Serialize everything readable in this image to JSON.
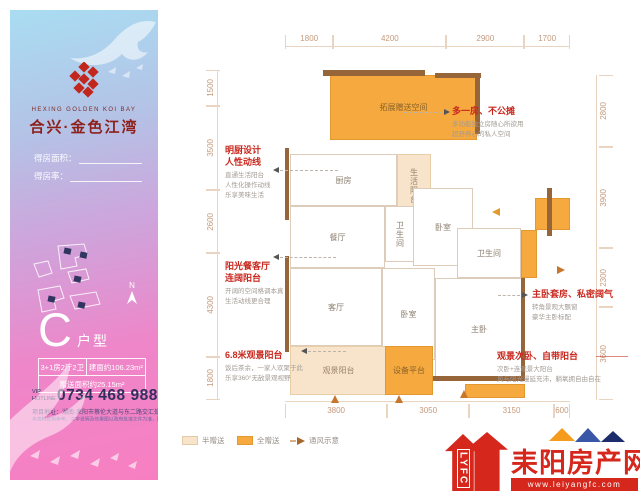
{
  "brand": {
    "en": "HEXING GOLDEN KOI BAY",
    "cn": "合兴·金色江湾"
  },
  "panel": {
    "area_label": "得房面积：",
    "rate_label": "得房率：",
    "compass": "N",
    "type_letter": "C",
    "type_suffix": "户型",
    "spec": {
      "layout": "3+1房2厅2卫",
      "area": "建面约106.23m²",
      "gift": "赠送面积约25.15m²"
    },
    "hotline_label": "VIP HOTLINE",
    "hotline_number": "0734 468 9888",
    "address": "项目地址：湖南·耒阳市蔡伦大道与东二路交汇处",
    "disclaimer": "本资料仅供参考，文字说明及效果图以政府批准文件为准，图为示意。"
  },
  "plan": {
    "dims": {
      "top": [
        "1800",
        "4200",
        "2900",
        "1700"
      ],
      "bottom": [
        "3800",
        "3050",
        "3150",
        "600"
      ],
      "left": [
        "1500",
        "3500",
        "2600",
        "4300",
        "1800"
      ],
      "right": [
        "2800",
        "3900",
        "2300",
        "3600"
      ]
    },
    "rooms": {
      "bonus": "拓展赠送空间",
      "kitchen": "厨房",
      "life_balcony": "生活阳台",
      "dining": "餐厅",
      "bath1": "卫生间",
      "bed1": "卧室",
      "bath2": "卫生间",
      "master": "主卧",
      "living": "客厅",
      "bed2": "卧室",
      "view_balcony": "观景阳台",
      "equip": "设备平台"
    },
    "legend": {
      "half": "半赠送",
      "full": "全赠送",
      "vent": "通风示意"
    },
    "colors": {
      "full_gift": "#f5a93f",
      "half_gift": "#f7e4cb",
      "wall": "#96653a",
      "dimension_text": "#c49a7d",
      "annotation_red": "#c9281e"
    }
  },
  "annotations": {
    "kitchen": {
      "title1": "明厨设计",
      "title2": "人性动线",
      "desc": [
        "直通生活阳台",
        "人性化操作动线",
        "乐享美味生活"
      ]
    },
    "dining": {
      "title1": "阳光餐客厅",
      "title2": "连阔阳台",
      "desc": [
        "开阔的空间格调本真",
        "生活动线更合理"
      ]
    },
    "balcony": {
      "title": "6.8米观景阳台",
      "desc": [
        "饭后茶余，一家人欢聚于此",
        "乐享360°无敌景观视野"
      ]
    },
    "bonus": {
      "title": "多一房、不公摊",
      "desc": [
        "多功能独立房随心所欲用",
        "超舒养心的私人空间"
      ]
    },
    "master": {
      "title": "主卧套房、私密阔气",
      "desc": [
        "转角景观大飘窗",
        "豪华主卧标配"
      ]
    },
    "bed2": {
      "title": "观景次卧、自带阳台",
      "desc": [
        "次卧+连观景大阳台",
        "风与阳光漫延充沛，躺氧拥自由自在"
      ]
    }
  },
  "footer": {
    "lyfc": "LYFC",
    "site": "耒阳房产网",
    "url": "www.leiyangfc.com",
    "brand_red": "#d6271c"
  }
}
